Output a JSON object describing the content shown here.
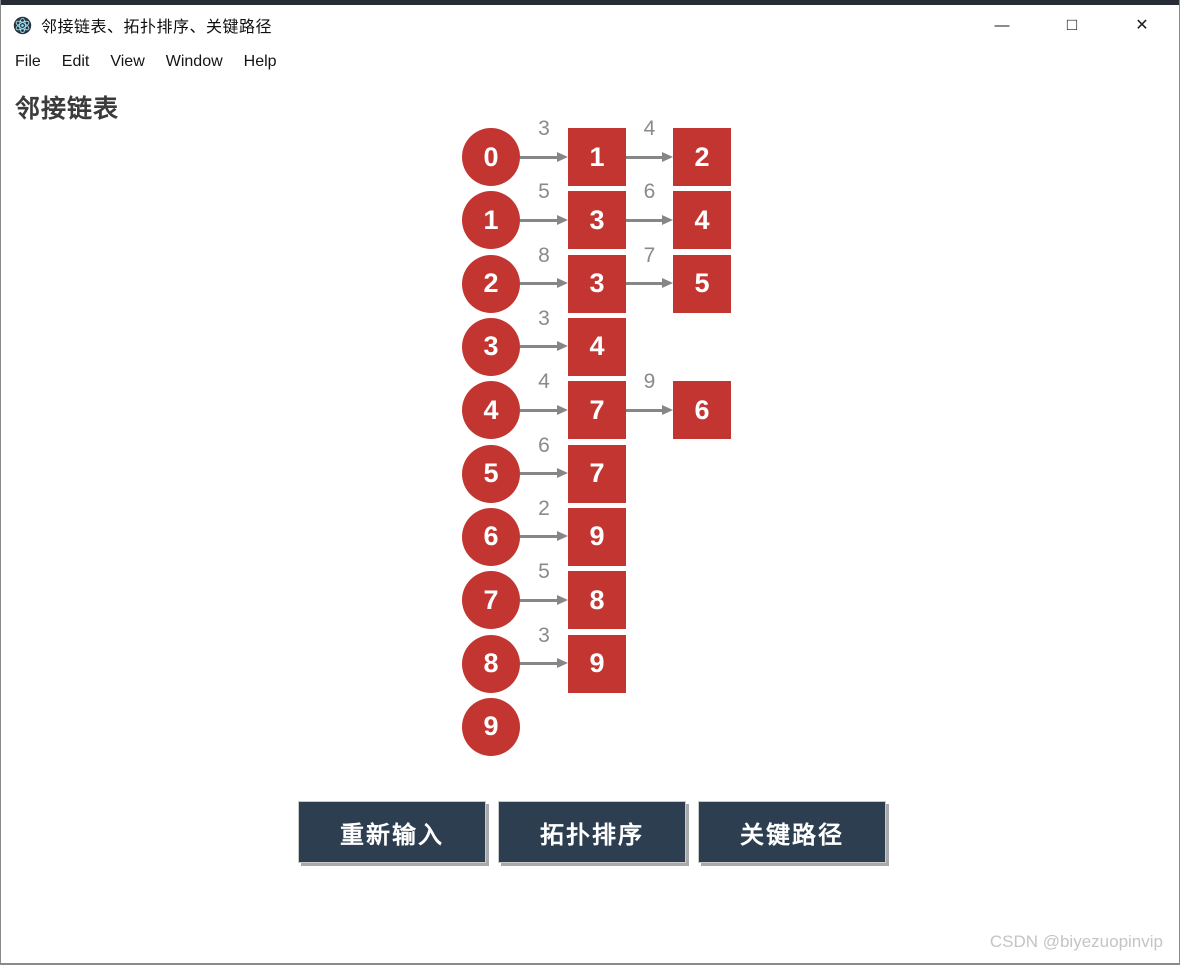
{
  "window": {
    "title": "邻接链表、拓扑排序、关键路径",
    "controls": {
      "minimize": "—",
      "maximize": "□",
      "close": "✕"
    }
  },
  "menu": {
    "items": [
      "File",
      "Edit",
      "View",
      "Window",
      "Help"
    ]
  },
  "page": {
    "heading": "邻接链表"
  },
  "graph": {
    "type": "adjacency-list",
    "rows": [
      {
        "node": "0",
        "edges": [
          {
            "weight": "3",
            "target": "1"
          },
          {
            "weight": "4",
            "target": "2"
          }
        ]
      },
      {
        "node": "1",
        "edges": [
          {
            "weight": "5",
            "target": "3"
          },
          {
            "weight": "6",
            "target": "4"
          }
        ]
      },
      {
        "node": "2",
        "edges": [
          {
            "weight": "8",
            "target": "3"
          },
          {
            "weight": "7",
            "target": "5"
          }
        ]
      },
      {
        "node": "3",
        "edges": [
          {
            "weight": "3",
            "target": "4"
          }
        ]
      },
      {
        "node": "4",
        "edges": [
          {
            "weight": "4",
            "target": "7"
          },
          {
            "weight": "9",
            "target": "6"
          }
        ]
      },
      {
        "node": "5",
        "edges": [
          {
            "weight": "6",
            "target": "7"
          }
        ]
      },
      {
        "node": "6",
        "edges": [
          {
            "weight": "2",
            "target": "9"
          }
        ]
      },
      {
        "node": "7",
        "edges": [
          {
            "weight": "5",
            "target": "8"
          }
        ]
      },
      {
        "node": "8",
        "edges": [
          {
            "weight": "3",
            "target": "9"
          }
        ]
      },
      {
        "node": "9",
        "edges": []
      }
    ]
  },
  "buttons": [
    {
      "label": "重新输入"
    },
    {
      "label": "拓扑排序"
    },
    {
      "label": "关键路径"
    }
  ],
  "watermark": "CSDN @biyezuopinvip",
  "colors": {
    "node_red": "#c23531",
    "button_navy": "#2d3e50",
    "arrow_gray": "#868686",
    "weight_gray": "#8a8a8a",
    "top_strip": "#262c33"
  }
}
